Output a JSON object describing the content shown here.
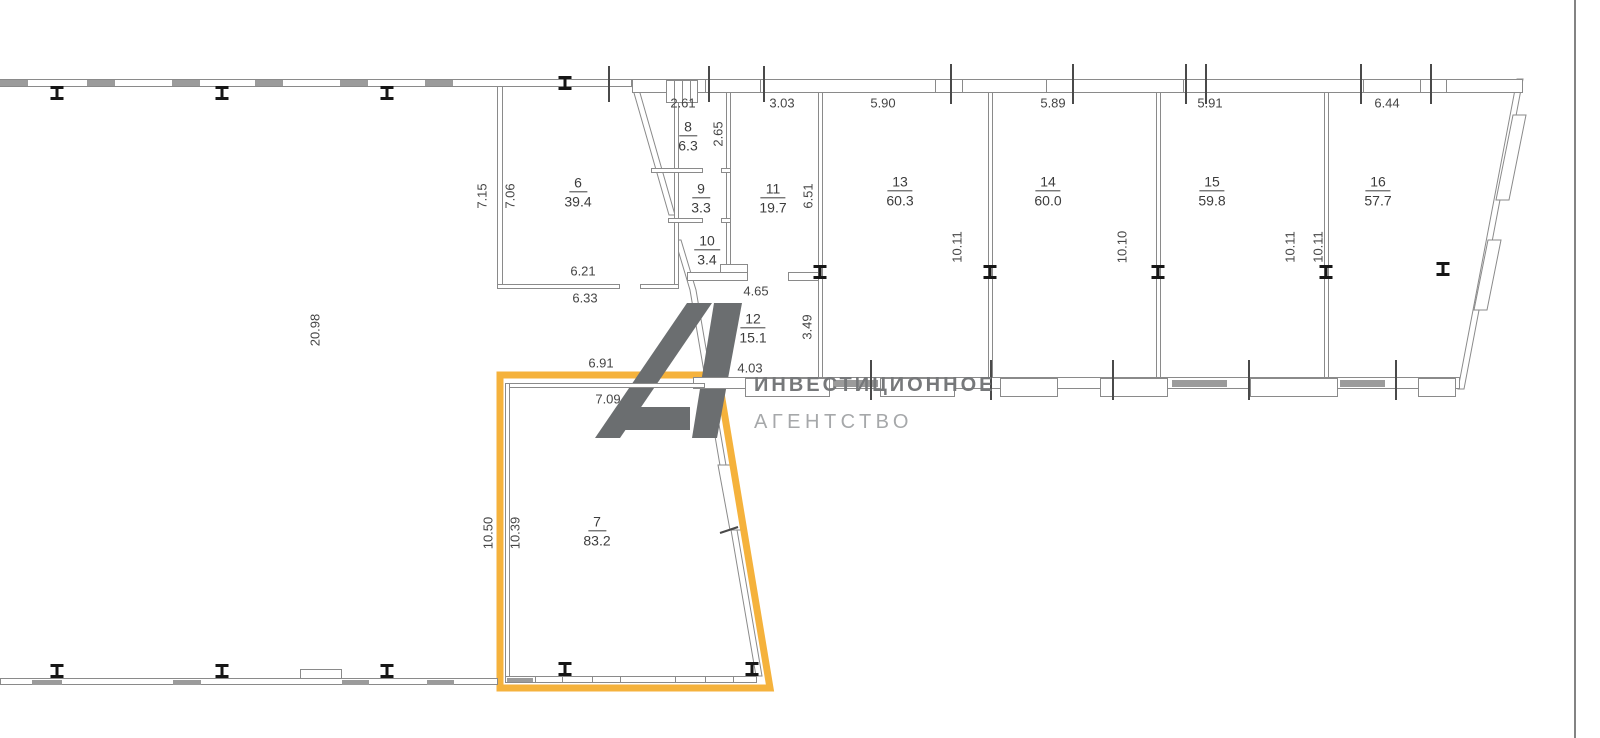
{
  "rooms": [
    {
      "num": "6",
      "area": "39.4"
    },
    {
      "num": "7",
      "area": "83.2"
    },
    {
      "num": "8",
      "area": "6.3"
    },
    {
      "num": "9",
      "area": "3.3"
    },
    {
      "num": "10",
      "area": "3.4"
    },
    {
      "num": "11",
      "area": "19.7"
    },
    {
      "num": "12",
      "area": "15.1"
    },
    {
      "num": "13",
      "area": "60.3"
    },
    {
      "num": "14",
      "area": "60.0"
    },
    {
      "num": "15",
      "area": "59.8"
    },
    {
      "num": "16",
      "area": "57.7"
    }
  ],
  "dims": {
    "top_261": "2.61",
    "top_303": "3.03",
    "top_590": "5.90",
    "top_589": "5.89",
    "top_591": "5.91",
    "top_644": "6.44",
    "r6_in": "6.21",
    "r6_out": "6.33",
    "r6_left_out": "7.15",
    "r6_left_in": "7.06",
    "r8_height": "2.65",
    "r11_height": "6.51",
    "r12_top": "4.65",
    "r12_bottom": "4.03",
    "r12_height": "3.49",
    "r13_height": "10.11",
    "r14_height": "10.10",
    "r15_height": "10.11",
    "r16_height": "10.11",
    "r7_out": "6.91",
    "r7_in": "7.09",
    "r7_left_out": "10.50",
    "r7_left_in": "10.39",
    "hall_width": "20.98"
  },
  "logo": {
    "line1": "ИНВЕСТИЦИОННОЕ",
    "line2": "АГЕНТСТВО"
  },
  "colors": {
    "highlight": "#F5B23C",
    "wall_line": "#8a8a8a",
    "wall_fill": "#9b9b9b",
    "logo_mark": "#6B6E70",
    "logo_text_primary": "#76787A",
    "logo_text_secondary": "#A6A8AA",
    "dim_text": "#454545"
  }
}
